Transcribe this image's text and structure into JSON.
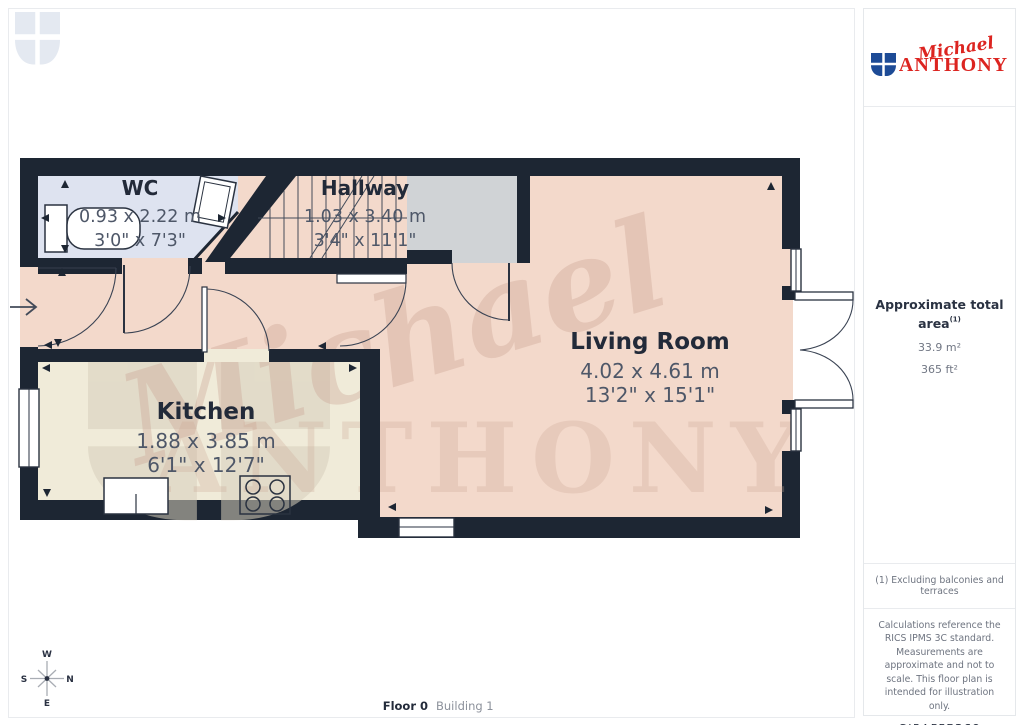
{
  "plan": {
    "rooms": [
      {
        "name": "WC",
        "metric": "0.93 x 2.22 m",
        "imperial": "3'0\" x 7'3\""
      },
      {
        "name": "Hallway",
        "metric": "1.03 x 3.40 m",
        "imperial": "3'4\" x 11'1\""
      },
      {
        "name": "Kitchen",
        "metric": "1.88 x 3.85 m",
        "imperial": "6'1\" x 12'7\""
      },
      {
        "name": "Living Room",
        "metric": "4.02 x 4.61 m",
        "imperial": "13'2\" x 15'1\""
      }
    ]
  },
  "watermark": {
    "script": "Michael",
    "caps": "ANTHONY"
  },
  "compass": {
    "top": "W",
    "right": "N",
    "bottom": "E",
    "left": "S"
  },
  "footer": {
    "floor_label": "Floor 0",
    "building_label": "Building 1"
  },
  "sidebar": {
    "logo_script": "Michael",
    "logo_name": "ANTHONY",
    "area_title": "Approximate total area",
    "area_sup": "(1)",
    "area_metric": "33.9 m²",
    "area_imperial": "365 ft²",
    "note_exclusions": "(1) Excluding balconies and terraces",
    "note_disclaimer": "Calculations reference the RICS IPMS 3C standard. Measurements are approximate and not to scale. This floor plan is intended for illustration only.",
    "brand_name": "GIRAFFE",
    "brand_suffix": "360"
  },
  "colors": {
    "wall": "#1d2633",
    "pink": "#f3d9cb",
    "cream": "#f0ebd9",
    "lavender": "#dee3f0",
    "gray": "#d0d3d6",
    "logo_red": "#dc2420",
    "logo_blue": "#1d4b96"
  }
}
